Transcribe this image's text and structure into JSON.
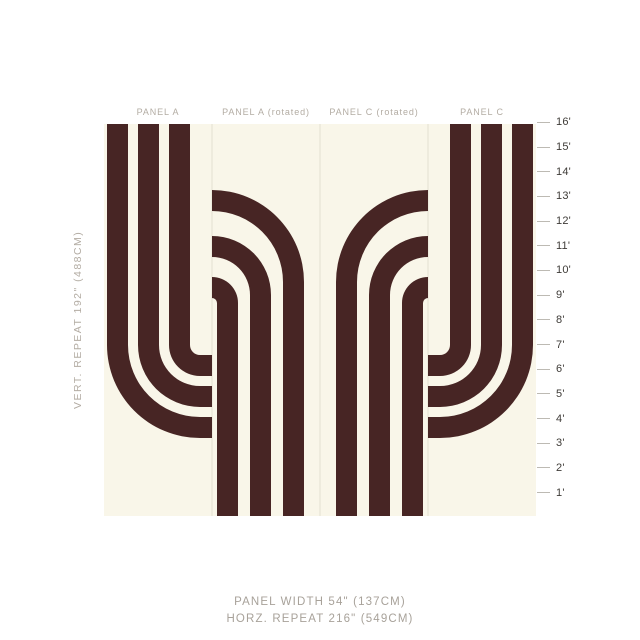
{
  "panels": {
    "labels": [
      "PANEL A",
      "PANEL A (rotated)",
      "PANEL C (rotated)",
      "PANEL C"
    ]
  },
  "ruler_labels": [
    "16'",
    "15'",
    "14'",
    "13'",
    "12'",
    "11'",
    "10'",
    "9'",
    "8'",
    "7'",
    "6'",
    "5'",
    "4'",
    "3'",
    "2'",
    "1'"
  ],
  "side_label": "VERT. REPEAT 192\" (488CM)",
  "captions": {
    "panel_width": "PANEL WIDTH 54\" (137CM)",
    "horz_repeat": "HORZ. REPEAT 216\" (549CM)"
  },
  "colors": {
    "page_bg": "#FFFFFF",
    "panel_bg": "#F9F6E9",
    "stripe": "#472524",
    "divider": "#E3E0D1",
    "tick_line": "#BDBAB3",
    "tick_label": "#3E3B37",
    "label_gray": "#B3ACA3",
    "caption_gray": "#A8A29A"
  }
}
